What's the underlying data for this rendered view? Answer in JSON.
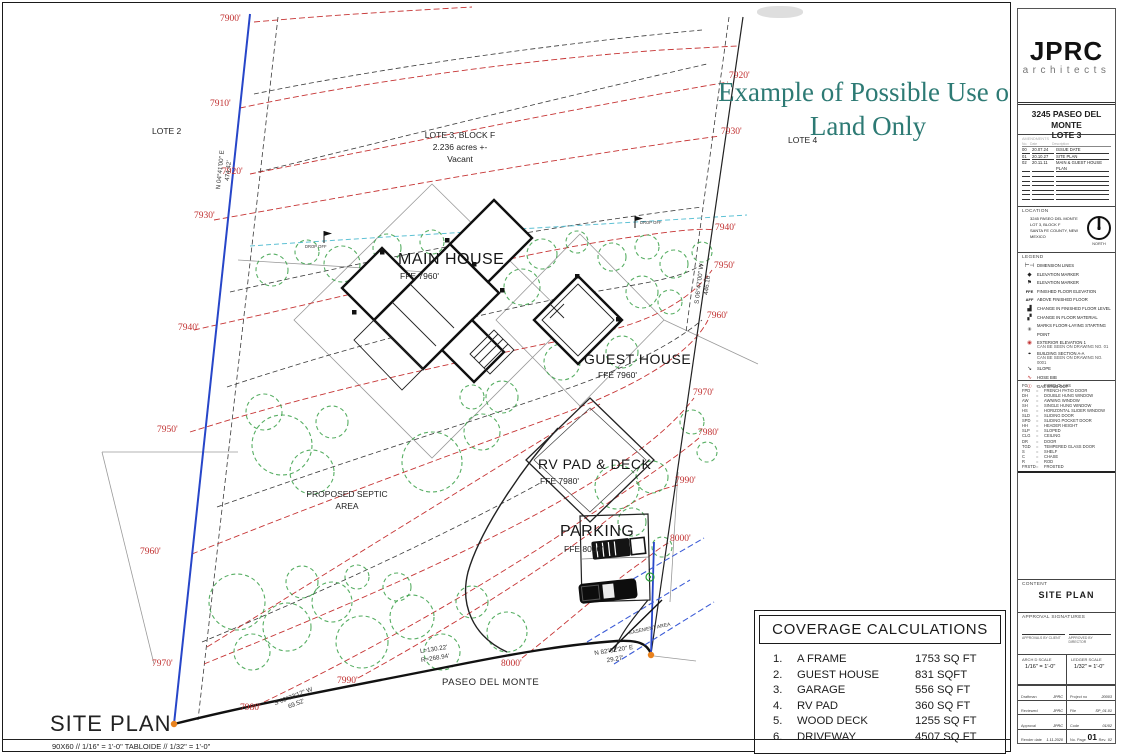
{
  "banner": {
    "line1": "Example of Possible Use of",
    "line2": "Land Only",
    "color": "#2d7a74"
  },
  "plan": {
    "title": "SITE PLAN",
    "scale_note": "90X60 //  1/16\" = 1'-0\"     TABLOIDE //  1/32\" = 1'-0\"",
    "lote2": "LOTE 2",
    "lote4": "LOTE 4",
    "lot3_line1": "LOTE 3, BLOCK F",
    "lot3_line2": "2.236 acres +-",
    "lot3_line3": "Vacant",
    "street": "PASEO DEL MONTE",
    "main_house": "MAIN HOUSE",
    "main_house_ffe": "FFE 7960'",
    "guest_house": "GUEST HOUSE",
    "guest_house_ffe": "FFE 7960'",
    "rv_pad": "RV PAD & DECK",
    "rv_pad_ffe": "FFE 7980'",
    "parking": "PARKING",
    "parking_ffe": "FFE 8000'",
    "septic_line1": "PROPOSED SEPTIC",
    "septic_line2": "AREA",
    "drop_off": "DROP OFF",
    "easement": "EASEMENT AREA",
    "contours_left": [
      "7900'",
      "7910'",
      "7920'",
      "7930'",
      "7940'",
      "7950'",
      "7960'",
      "7970'",
      "7980'",
      "7990'",
      "8000'"
    ],
    "contours_right": [
      "7920'",
      "7930'",
      "7940'",
      "7950'",
      "7960'",
      "7970'",
      "7980'",
      "7990'",
      "8000'"
    ],
    "bearing_west": "N 04°41'00\" E",
    "bearing_west_len": "474.42'",
    "bearing_east": "S 06°47'00\" W",
    "bearing_east_len": "446.16'",
    "bearing_sw": "S 69°23'12\" W",
    "bearing_sw_len": "69.52'",
    "bearing_se": "N 82°52'20\" E",
    "bearing_se_len": "29.27'",
    "curve_l": "L=130.22'",
    "curve_r": "R=268.94'"
  },
  "coverage": {
    "title": "COVERAGE CALCULATIONS",
    "rows": [
      {
        "no": "1.",
        "item": "A FRAME",
        "area": "1753 SQ FT"
      },
      {
        "no": "2.",
        "item": "GUEST HOUSE",
        "area": "831 SQFT"
      },
      {
        "no": "3.",
        "item": "GARAGE",
        "area": "556 SQ FT"
      },
      {
        "no": "4.",
        "item": "RV PAD",
        "area": "360 SQ FT"
      },
      {
        "no": "5.",
        "item": "WOOD DECK",
        "area": "1255 SQ FT"
      },
      {
        "no": "6.",
        "item": "DRIVEWAY",
        "area": "4507 SQ FT"
      }
    ]
  },
  "titleblock": {
    "firm": "JPRC",
    "firm_sub": "architects",
    "project_line1": "3245 PASEO DEL MONTE",
    "project_line2": "LOTE 3",
    "amend_title": "AMENDMENTS",
    "amend_headers": {
      "no": "No.",
      "date": "Date",
      "desc": "Description"
    },
    "amendments": [
      {
        "no": "00",
        "date": "20.07.24",
        "desc": "ISSUE DATE"
      },
      {
        "no": "01",
        "date": "20.10.27",
        "desc": "SITE PLAN"
      },
      {
        "no": "02",
        "date": "20.11.11",
        "desc": "MAIN & GUEST HOUSE PLAN"
      }
    ],
    "location_title": "LOCATION",
    "location_line1": "3245 PASEO DEL MONTE",
    "location_line2": "LOT 3, BLOCK F",
    "location_line3": "SANTA FE COUNTY, NEW MEXICO",
    "north_label": "NORTH",
    "legend_title": "LEGEND",
    "eq": "=",
    "legend_items": [
      {
        "glyph": "⊢⊣",
        "label": "DIMENSION LINES"
      },
      {
        "glyph": "◆",
        "label": "ELEVATION MARKER"
      },
      {
        "glyph": "⚑",
        "label": "ELEVATION MARKER"
      },
      {
        "glyph": "FFE",
        "label": "FINISHED FLOOR ELEVATION"
      },
      {
        "glyph": "AFF",
        "label": "ABOVE FINISHED FLOOR"
      },
      {
        "glyph": "▟",
        "label": "CHANGE IN FINISHED FLOOR LEVEL"
      },
      {
        "glyph": "▞",
        "label": "CHANGE IN FLOOR MATERIAL"
      },
      {
        "glyph": "✳",
        "label": "MARKS FLOOR-LAYING STARTING POINT"
      },
      {
        "glyph": "◉",
        "label": "EXTERIOR ELEVATION 1",
        "label2": "CAN BE SEEN ON DRAWING NO. 01"
      },
      {
        "glyph": "⌖",
        "label": "BUILDING SECTION A-A",
        "label2": "CAN BE SEEN ON DRAWING NO. 0001"
      },
      {
        "glyph": "↘",
        "label": "SLOPE"
      },
      {
        "glyph": "∿",
        "label": "HOSE BIB"
      },
      {
        "glyph": "☉",
        "label": "GAS STUB OUT"
      }
    ],
    "abbreviations": [
      {
        "abbr": "FG",
        "label": "FIXED GLASS"
      },
      {
        "abbr": "FPD",
        "label": "FRENCH PATIO DOOR"
      },
      {
        "abbr": "DH",
        "label": "DOUBLE HUNG WINDOW"
      },
      {
        "abbr": "AW",
        "label": "AWNING WINDOW"
      },
      {
        "abbr": "SH",
        "label": "SINGLE HUNG WINDOW"
      },
      {
        "abbr": "HS",
        "label": "HORIZONTAL SLIDER WINDOW"
      },
      {
        "abbr": "SLD",
        "label": "SLIDING DOOR"
      },
      {
        "abbr": "SPD",
        "label": "SLIDING POCKET DOOR"
      },
      {
        "abbr": "HH",
        "label": "HEADER HEIGHT"
      },
      {
        "abbr": "SLP",
        "label": "SLOPED"
      },
      {
        "abbr": "CLG",
        "label": "CEILING"
      },
      {
        "abbr": "DR",
        "label": "DOOR"
      },
      {
        "abbr": "TGD",
        "label": "TEMPERED GLASS DOOR"
      },
      {
        "abbr": "S",
        "label": "SHELF"
      },
      {
        "abbr": "C",
        "label": "CHASE"
      },
      {
        "abbr": "R",
        "label": "ROD"
      },
      {
        "abbr": "FRSTD",
        "label": "FROSTED"
      }
    ],
    "content_title": "CONTENT",
    "content_value": "SITE PLAN",
    "approval_title": "APPROVAL SIGNATURES",
    "approval_client": "APPROVALS BY CLIENT",
    "approval_director": "APPROVED BY DIRECTOR",
    "scale1_label": "ARCH D SCALE",
    "scale1_value": "1/16\" = 1'-0\"",
    "scale2_label": "LEDGER SCALE",
    "scale2_value": "1/32\" = 1'-0\"",
    "fields_left": [
      {
        "label": "Draftman",
        "value": "JPRC"
      },
      {
        "label": "Reviewed",
        "value": "JPRC"
      },
      {
        "label": "Approval",
        "value": "JPRC"
      },
      {
        "label": "Render date",
        "value": "1.11.2020"
      }
    ],
    "fields_right": [
      {
        "label": "Project no",
        "value": "20003"
      },
      {
        "label": "File",
        "value": "SP_01.01"
      },
      {
        "label": "Code",
        "value": "01/02"
      }
    ],
    "page_label": "No. Page",
    "page_value": "01",
    "rev_label": "Rev.",
    "rev_value": "02"
  }
}
